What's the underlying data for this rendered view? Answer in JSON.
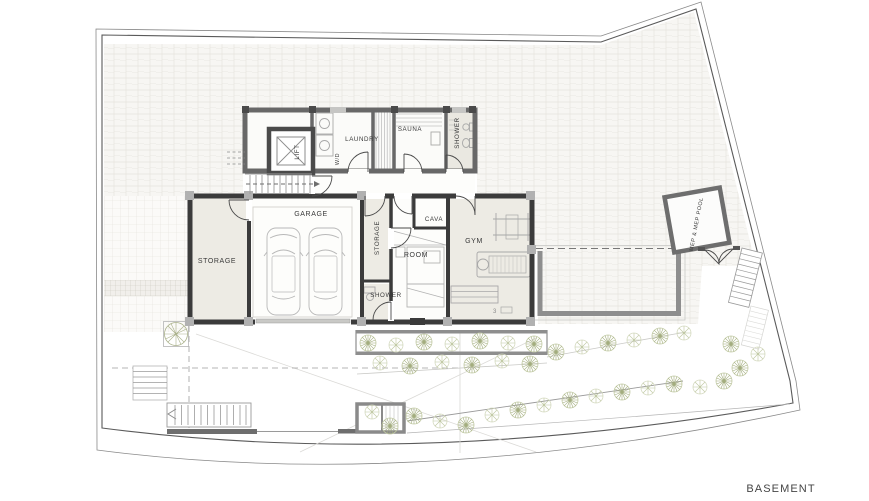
{
  "plan": {
    "title": "BASEMENT",
    "labels": {
      "storage_left": "STORAGE",
      "garage": "GARAGE",
      "storage_mid": "STORAGE",
      "shower_small": "SHOWER",
      "cava": "CAVA",
      "room": "ROOM",
      "gym": "GYM",
      "gym_note": "3",
      "lift": "LIFT",
      "wd": "W/D",
      "laundry": "LAUNDRY",
      "sauna": "SAUNA",
      "shower_top": "SHOWER",
      "mep": "MEP & MEP POOL"
    },
    "colors": {
      "wall_dark": "#3b3b3b",
      "wall_medium": "#686868",
      "pool_wall": "#8e8e8e",
      "paver_bg": "#f7f6f3",
      "paver_line": "#e6e4de",
      "room_fill": "#edebe4",
      "plant_green": "#a3ad7e",
      "text": "#3a3a3a"
    }
  }
}
